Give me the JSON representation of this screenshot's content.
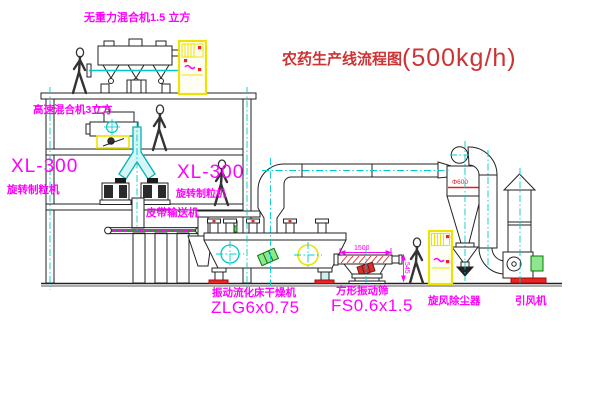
{
  "title": {
    "text": "农药生产线流程图",
    "capacity": "(500kg/h)"
  },
  "labels": {
    "gravity_mixer": "无重力混合机1.5 立方",
    "high_speed_mixer": "高速混合机3立方",
    "granulator_left_model": "XL-300",
    "granulator_left_name": "旋转制粒机",
    "granulator_mid_model": "XL-300",
    "granulator_mid_name": "旋转制粒机",
    "belt_conveyor": "皮带输送机",
    "dryer_name": "振动流化床干燥机",
    "dryer_model": "ZLG6x0.75",
    "sieve_name": "方形振动筛",
    "sieve_model": "FS0.6x1.5",
    "cyclone": "旋风除尘器",
    "fan": "引风机"
  },
  "dimensions": {
    "sieve_length": "1500",
    "sieve_outlet_height": "545",
    "cyclone_diameter": "Φ600"
  },
  "colors": {
    "label_magenta": "#ff00ff",
    "title_red": "#cd3333",
    "centerline_cyan": "#00cccc",
    "cabinet_yellow": "#ece400",
    "motor_green": "#2e8b2e",
    "alert_red": "#ee2222",
    "line_black": "#222222"
  }
}
